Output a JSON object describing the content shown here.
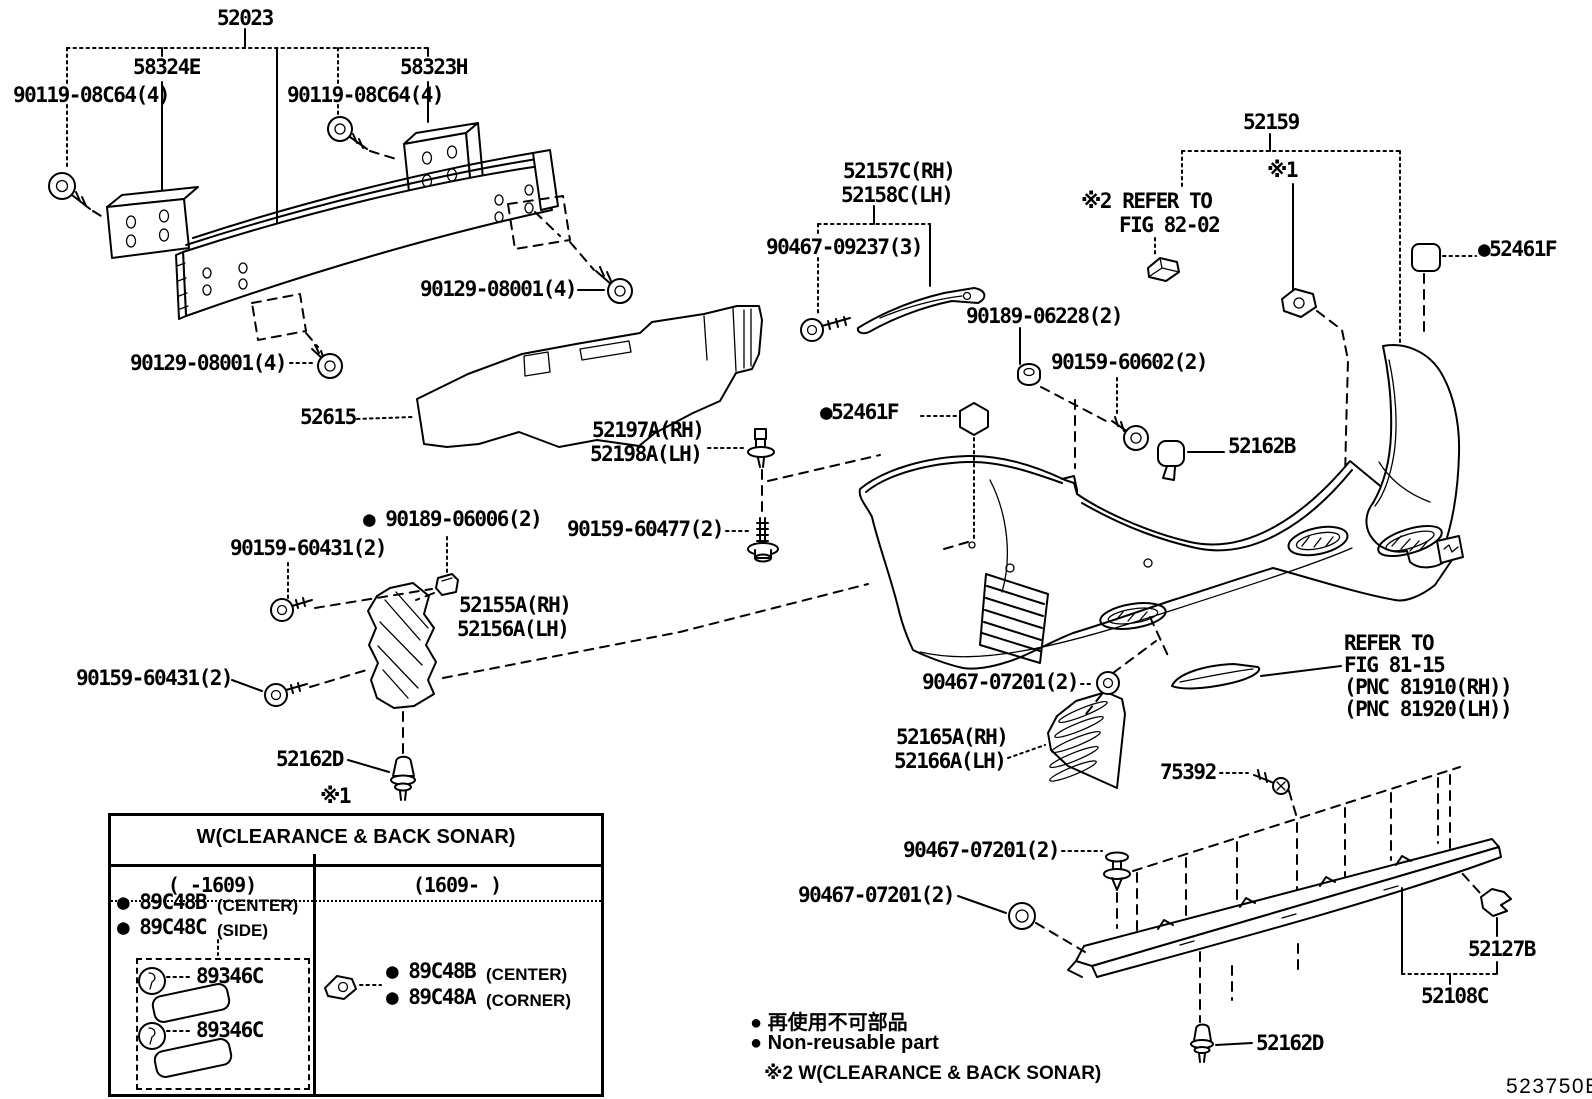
{
  "labels": [
    {
      "text": "52023"
    },
    {
      "text": "58324E"
    },
    {
      "text": "90119-08C64(4)"
    },
    {
      "text": "58323H"
    },
    {
      "text": "90119-08C64(4)"
    },
    {
      "text": "90129-08001(4)"
    },
    {
      "text": "90129-08001(4)"
    },
    {
      "text": "52615"
    },
    {
      "text": "52157C(RH)"
    },
    {
      "text": "52158C(LH)"
    },
    {
      "text": "90467-09237(3)"
    },
    {
      "text": "52159"
    },
    {
      "text": "※1"
    },
    {
      "text": "※2 REFER TO"
    },
    {
      "text": "FIG 82-02"
    },
    {
      "text": "●52461F"
    },
    {
      "text": "90189-06228(2)"
    },
    {
      "text": "90159-60602(2)"
    },
    {
      "text": "●52461F"
    },
    {
      "text": "52162B"
    },
    {
      "text": "52197A(RH)"
    },
    {
      "text": "52198A(LH)"
    },
    {
      "text": "● 90189-06006(2)"
    },
    {
      "text": "90159-60431(2)"
    },
    {
      "text": "90159-60477(2)"
    },
    {
      "text": "52155A(RH)"
    },
    {
      "text": "52156A(LH)"
    },
    {
      "text": "90159-60431(2)"
    },
    {
      "text": "52162D"
    },
    {
      "text": "※1"
    },
    {
      "text": "90467-07201(2)"
    },
    {
      "text": "52165A(RH)"
    },
    {
      "text": "52166A(LH)"
    },
    {
      "text": "75392"
    },
    {
      "text": "REFER TO"
    },
    {
      "text": "FIG 81-15"
    },
    {
      "text": "(PNC 81910(RH))"
    },
    {
      "text": "(PNC 81920(LH))"
    },
    {
      "text": "90467-07201(2)"
    },
    {
      "text": "90467-07201(2)"
    },
    {
      "text": "52127B"
    },
    {
      "text": "52108C"
    },
    {
      "text": "52162D"
    }
  ],
  "table": {
    "header": "W(CLEARANCE & BACK SONAR)",
    "col_left": "(  -1609)",
    "col_right": "(1609-  )",
    "left_items": [
      {
        "part": "● 89C48B",
        "suffix": "(CENTER)"
      },
      {
        "part": "● 89C48C",
        "suffix": "(SIDE)"
      }
    ],
    "inner_labels": [
      "89346C",
      "89346C"
    ],
    "right_items": [
      {
        "part": "● 89C48B",
        "suffix": "(CENTER)"
      },
      {
        "part": "● 89C48A",
        "suffix": "(CORNER)"
      }
    ]
  },
  "footer": {
    "note_jp": "● 再使用不可部品",
    "note_en": "● Non-reusable part",
    "note_sonar": "※2 W(CLEARANCE & BACK SONAR)",
    "figure_code": "523750E"
  }
}
